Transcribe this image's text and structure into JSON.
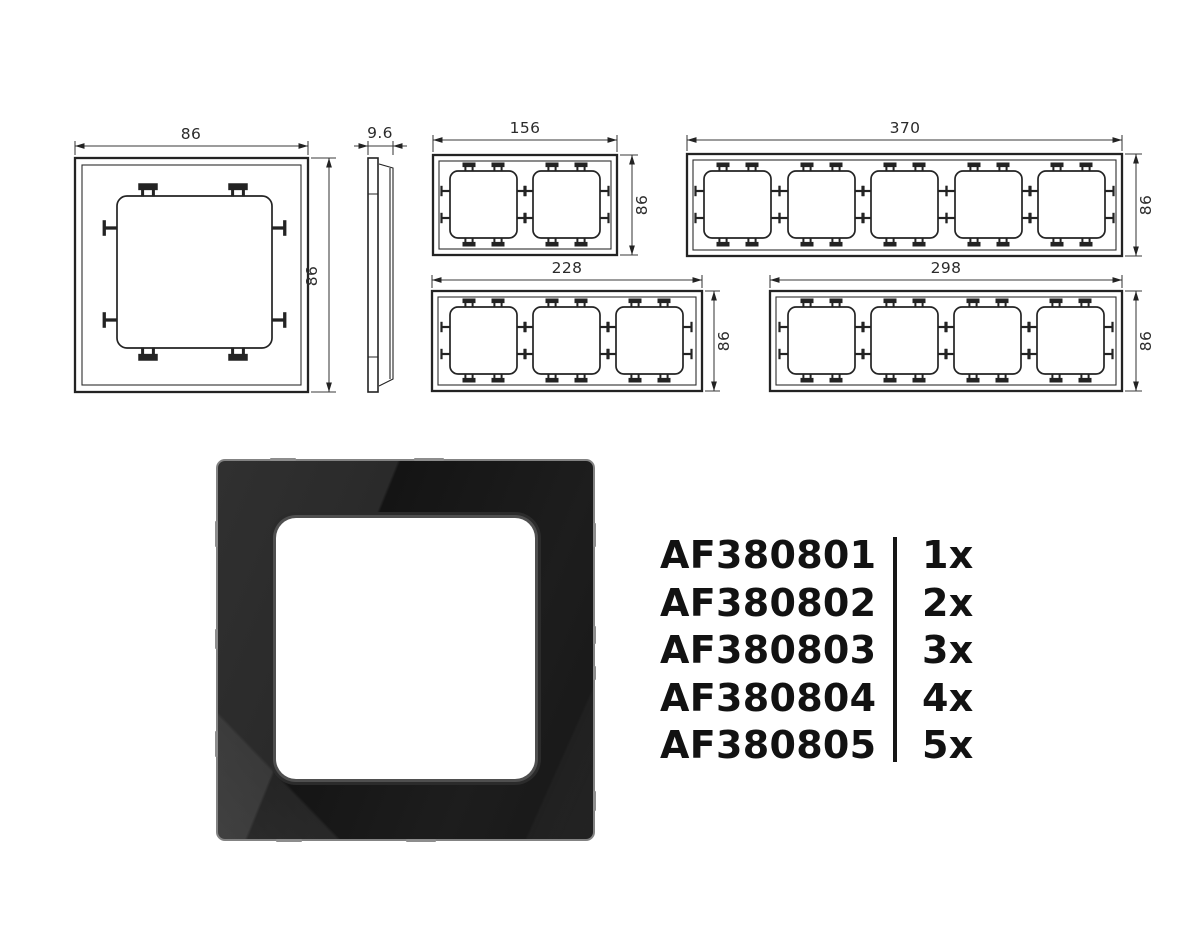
{
  "drawings": {
    "single_front": {
      "width_label": "86",
      "height_label": "86"
    },
    "side_profile": {
      "depth_label": "9.6"
    },
    "two_gang": {
      "width_label": "156",
      "height_label": "86"
    },
    "five_gang": {
      "width_label": "370",
      "height_label": "86"
    },
    "three_gang": {
      "width_label": "228",
      "height_label": "86"
    },
    "four_gang": {
      "width_label": "298",
      "height_label": "86"
    }
  },
  "product_list": {
    "items": [
      {
        "model": "AF380801",
        "quantity": "1x"
      },
      {
        "model": "AF380802",
        "quantity": "2x"
      },
      {
        "model": "AF380803",
        "quantity": "3x"
      },
      {
        "model": "AF380804",
        "quantity": "4x"
      },
      {
        "model": "AF380805",
        "quantity": "5x"
      }
    ]
  },
  "colors": {
    "line": "#232323",
    "text": "#121212",
    "photo_glass": "#1b1b1b",
    "photo_edge": "#838383",
    "opening": "#ffffff"
  }
}
